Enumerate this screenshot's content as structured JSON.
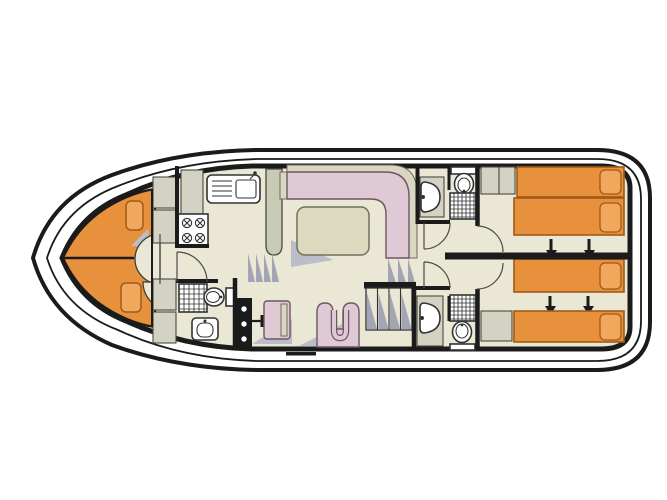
{
  "title": "houseboat-deck-plan",
  "colors": {
    "outline": "#1b1b1b",
    "hull": "#ffffff",
    "floor_beige": "#eae7d4",
    "orange": "#e8913c",
    "orange_light": "#f1a75c",
    "bed_border": "#a05a18",
    "cabinet_gray": "#d4d2c3",
    "cabinet_green": "#c8cbb3",
    "sofa_pink": "#dfc9d5",
    "sofa_back": "#d9d6c1",
    "sofa_outline": "#6e5662",
    "table_fill": "#dcd9bf",
    "step_gray": "#a3a5b4",
    "shadow": "#bcbdca",
    "fixture": "#333333"
  },
  "plan": {
    "vessel": "canal-cruiser-single-deck-floor-plan",
    "areas": [
      "bow-lounge",
      "galley",
      "fore-bathroom",
      "saloon",
      "helm-station",
      "stairs-to-aft-deck",
      "ensuite-bathroom-top",
      "ensuite-bathroom-bottom",
      "cabin-top",
      "cabin-bottom"
    ],
    "furniture": {
      "bow_lounge": [
        "seat-cushion",
        "seat-cushion",
        "door"
      ],
      "galley": [
        "sink-with-drainer",
        "stove-4-burners",
        "counter",
        "tall-unit"
      ],
      "fore_bathroom": [
        "shower",
        "toilet",
        "washbasin"
      ],
      "saloon": [
        "l-shaped-sofa",
        "table",
        "helm-console",
        "helm-seat",
        "armchair"
      ],
      "cabin_top": [
        "single-bed",
        "single-bed",
        "wardrobe",
        "slide-arrows"
      ],
      "cabin_bottom": [
        "single-bed",
        "single-bed",
        "wardrobe",
        "slide-arrows"
      ],
      "ensuite_top": [
        "washbasin",
        "toilet",
        "shower"
      ],
      "ensuite_bottom": [
        "washbasin",
        "toilet",
        "shower"
      ]
    },
    "bed_arrows_meaning": "beds-slide-together"
  }
}
